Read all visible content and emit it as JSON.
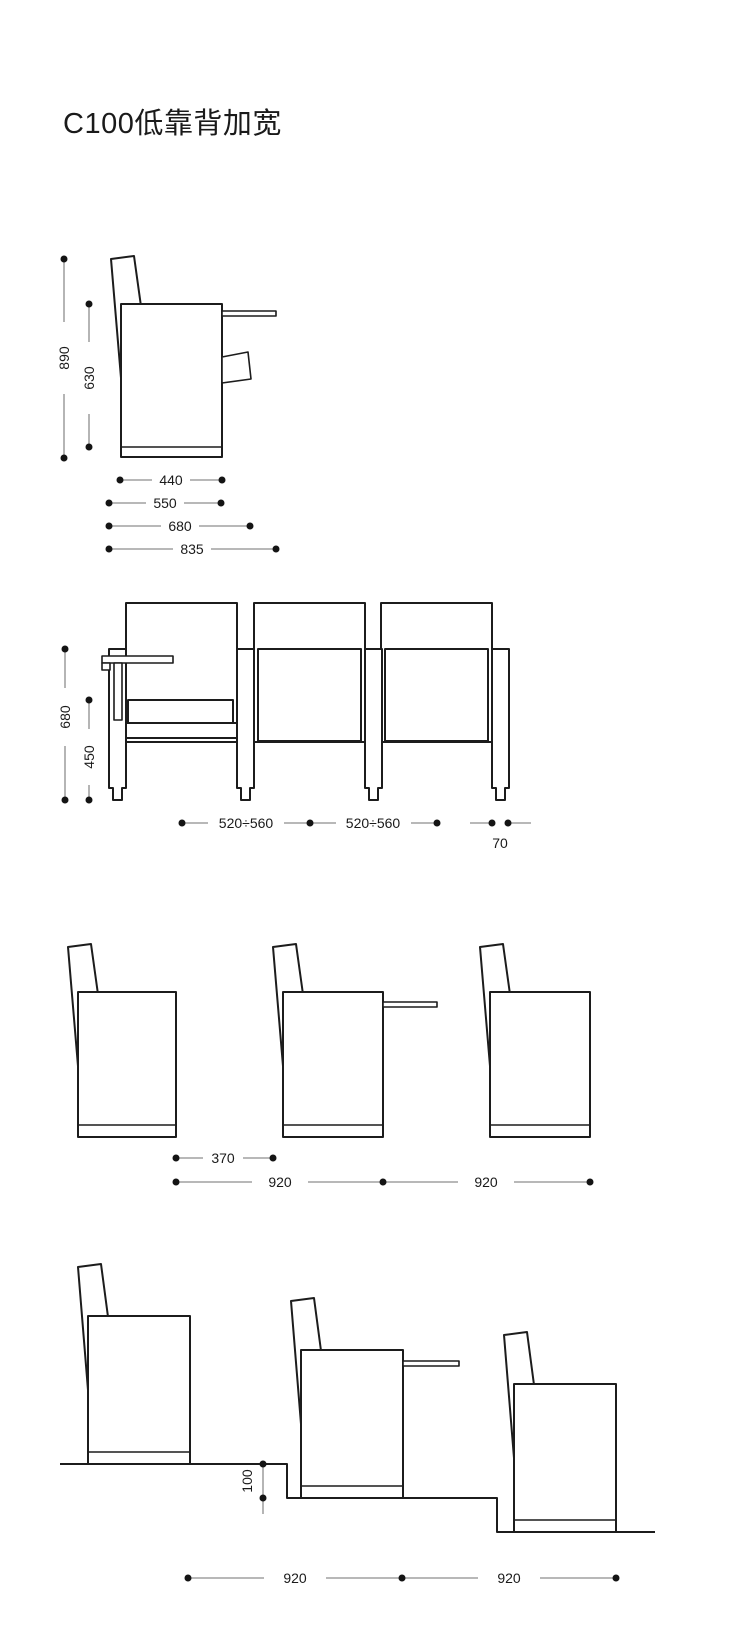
{
  "title": "C100低靠背加宽",
  "colors": {
    "background": "#ffffff",
    "outline": "#1c1c1c",
    "dimension_line": "#8d8d8d",
    "dimension_text": "#1a1a1a"
  },
  "views": {
    "single_seat_side": {
      "dims": {
        "total_height": "890",
        "seat_height": "630",
        "seat_depth": "440",
        "depth_550": "550",
        "depth_680": "680",
        "depth_total": "835"
      }
    },
    "three_seat_front": {
      "dims": {
        "armrest_height": "680",
        "seat_height": "450",
        "seat_width_left": "520÷560",
        "seat_width_right": "520÷560",
        "support_width": "70"
      }
    },
    "row_flat": {
      "dims": {
        "row_clearance": "370",
        "row_pitch_1": "920",
        "row_pitch_2": "920"
      }
    },
    "row_stepped": {
      "dims": {
        "step_riser": "100",
        "row_pitch_1": "920",
        "row_pitch_2": "920"
      }
    }
  }
}
